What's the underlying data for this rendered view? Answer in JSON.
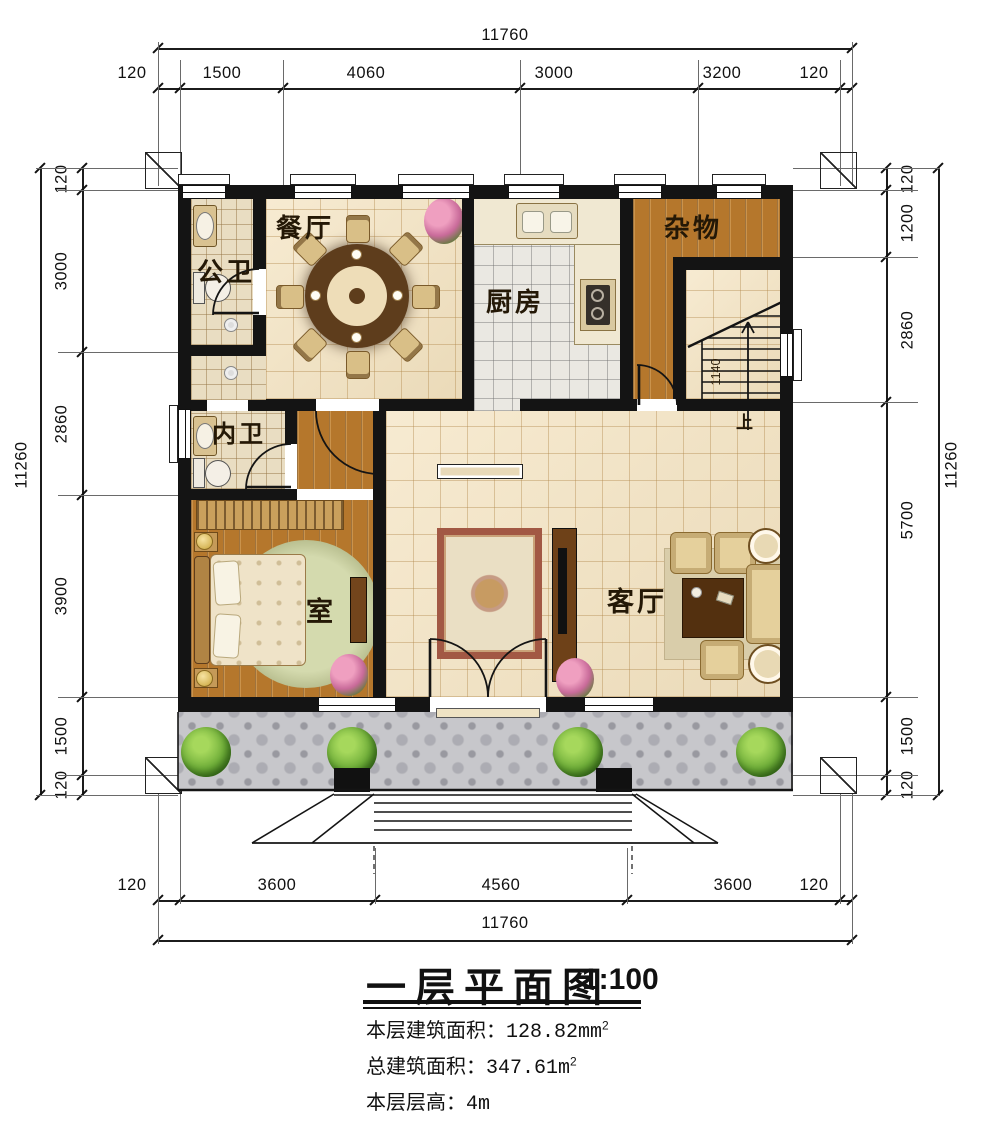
{
  "title": {
    "text": "一层平面图",
    "scale": "1:100"
  },
  "info": [
    {
      "label": "本层建筑面积：",
      "value": "128.82mm",
      "sup": "2"
    },
    {
      "label": "总建筑面积：",
      "value": "347.61m",
      "sup": "2"
    },
    {
      "label": "本层层高：",
      "value": "4m",
      "sup": ""
    }
  ],
  "dims": {
    "top": {
      "total": "11760",
      "segments": [
        "120",
        "1500",
        "4060",
        "3000",
        "3200",
        "120"
      ]
    },
    "bottom": {
      "total": "11760",
      "segments": [
        "120",
        "3600",
        "4560",
        "3600",
        "120"
      ]
    },
    "left": {
      "total": "11260",
      "segments": [
        "120",
        "3000",
        "2860",
        "3900",
        "1500",
        "120"
      ]
    },
    "right": {
      "total": "11260",
      "segments": [
        "120",
        "1200",
        "2860",
        "5700",
        "1500",
        "120"
      ]
    }
  },
  "rooms": {
    "dining": "餐厅",
    "public_bath": "公卫",
    "kitchen": "厨房",
    "storage": "杂物",
    "inner_bath": "内卫",
    "bedroom": "室",
    "living": "客厅"
  },
  "stairs": {
    "up": "上",
    "width": "1140"
  },
  "colors": {
    "wall": "#141414",
    "floor_tile": "#f4e3c0",
    "wood_floor": "#b5772c",
    "kitchen_tile": "#eae8e2",
    "bath_tile": "#e9ddc2",
    "porch_tile": "#c7c7cb",
    "tree": "#6fae39"
  }
}
